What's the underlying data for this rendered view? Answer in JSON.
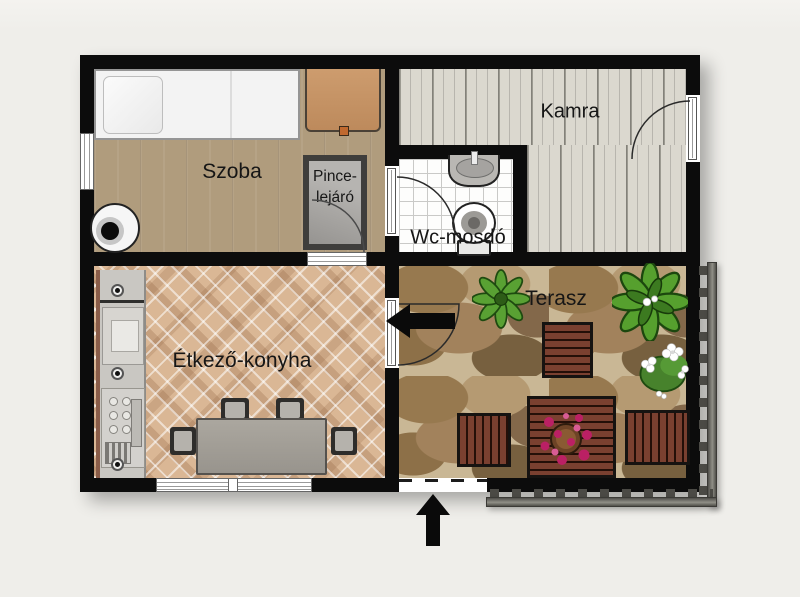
{
  "plan": {
    "labels": {
      "szoba": "Szoba",
      "pince_line1": "Pince-",
      "pince_line2": "lejáró",
      "kamra": "Kamra",
      "wc": "Wc-mosdó",
      "konyha": "Étkező-konyha",
      "terasz": "Terasz"
    },
    "colors": {
      "background": "#f0efeb",
      "wall": "#0c0c0c",
      "room_wood_floor": "#b09c7d",
      "pantry_floor": "#dbd8cf",
      "kitchen_brick": "#dab795",
      "terrace_stone": "#a98d68",
      "terrace_wood_furniture": "#6e3a28",
      "fence_gray": "#75756f",
      "plant_green": "#4a8f2c",
      "flowers_pink": "#c2266b",
      "flowers_white": "#ffffff"
    },
    "icons": {
      "entrance_side": "arrow-left",
      "entrance_main": "arrow-up"
    }
  }
}
